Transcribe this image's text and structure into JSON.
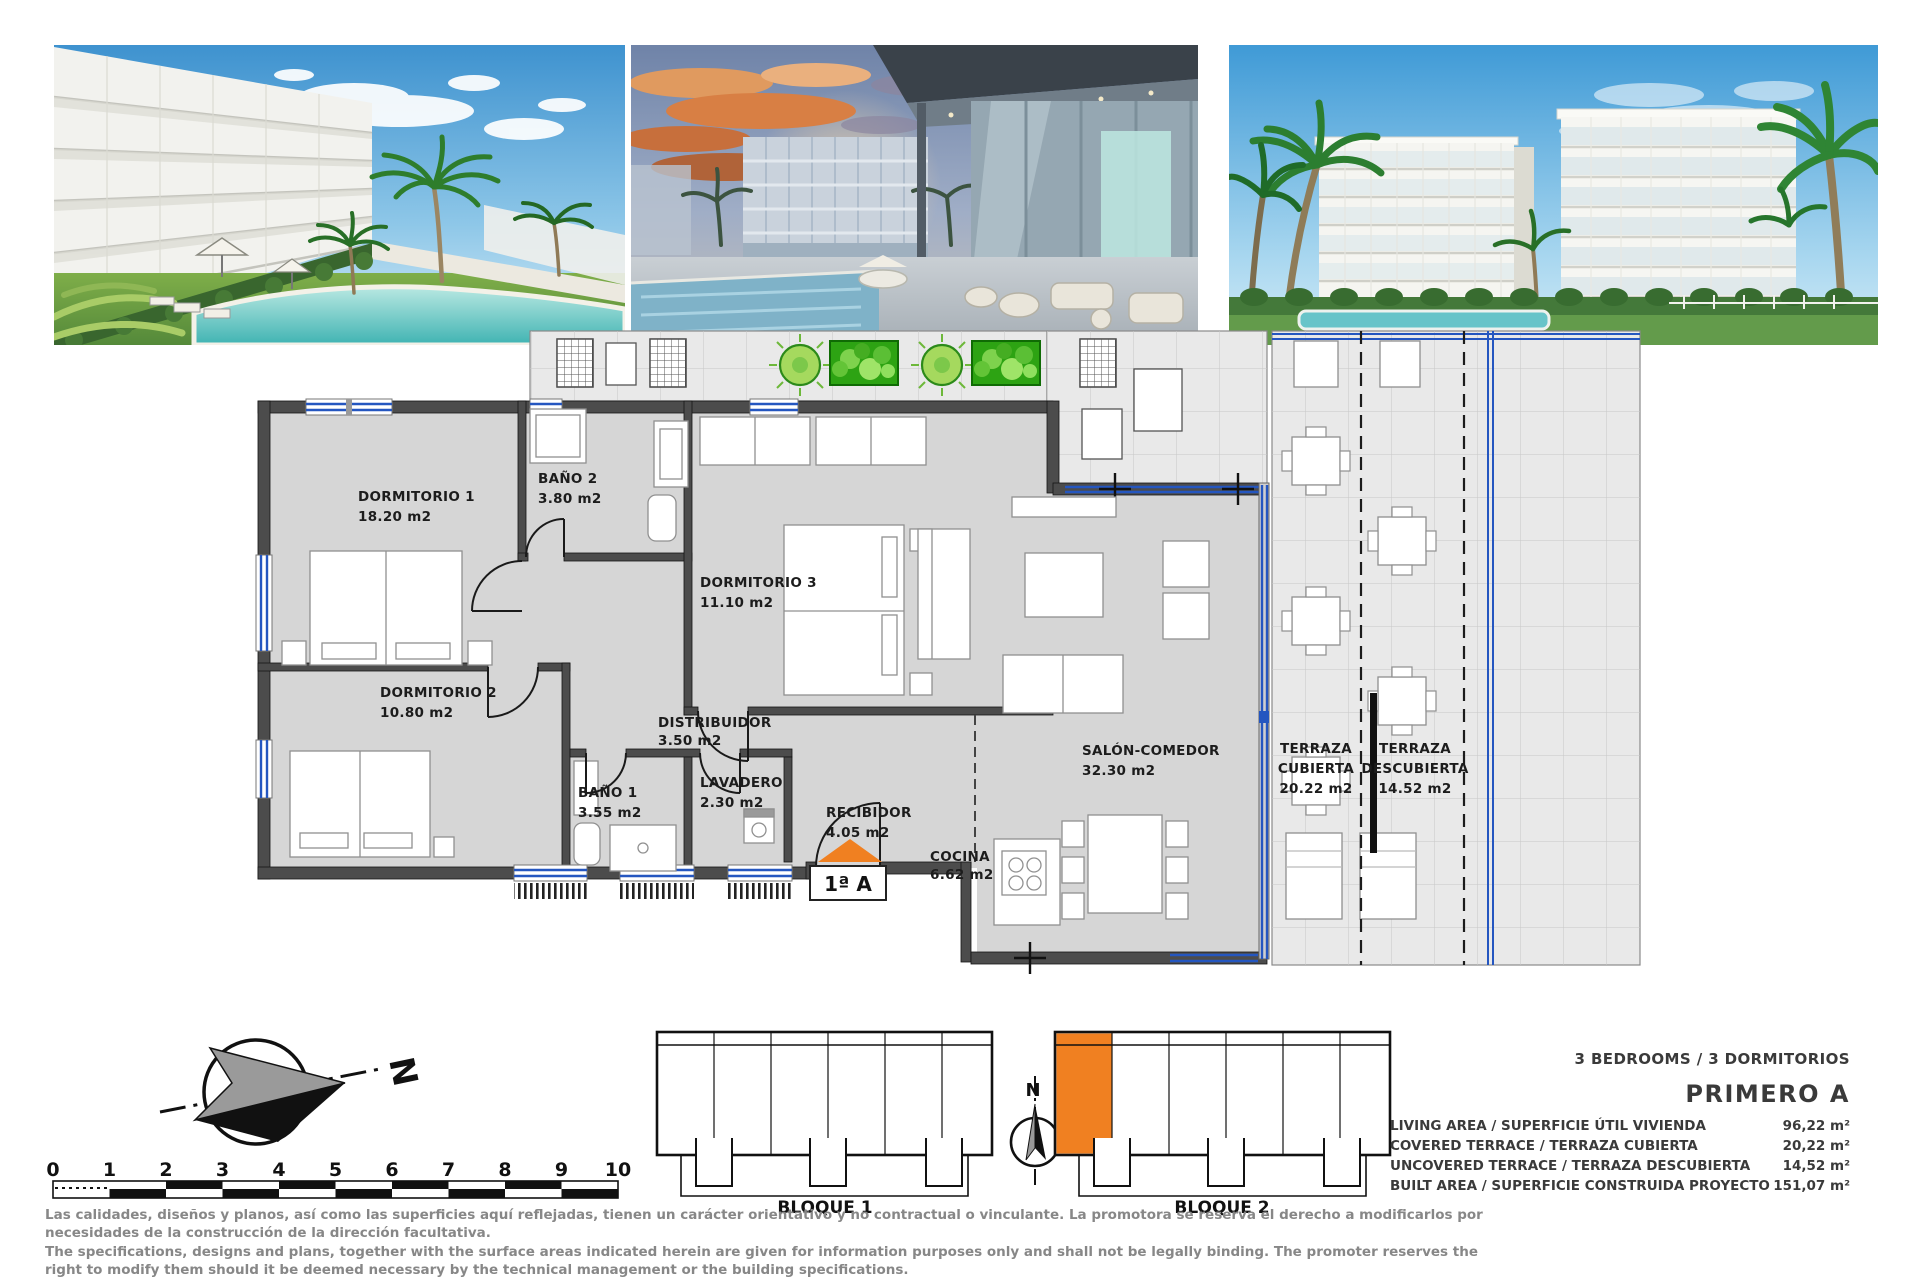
{
  "colors": {
    "accent_orange": "#f08021",
    "window_blue": "#2456c0",
    "plan_wall": "#4c4c4c",
    "plan_floor": "#d6d6d6",
    "terrace_floor": "#e9e9e9",
    "plant_green": "#45b31e",
    "disclaimer_gray": "#878787"
  },
  "floor_plan": {
    "unit_badge": "1ª A",
    "rooms": [
      {
        "id": "dormitorio-1",
        "line1": "DORMITORIO 1",
        "line2": "18.20 m2"
      },
      {
        "id": "bano-2",
        "line1": "BAÑO 2",
        "line2": "3.80 m2"
      },
      {
        "id": "dormitorio-3",
        "line1": "DORMITORIO 3",
        "line2": "11.10 m2"
      },
      {
        "id": "dormitorio-2",
        "line1": "DORMITORIO 2",
        "line2": "10.80 m2"
      },
      {
        "id": "distribuidor",
        "line1": "DISTRIBUIDOR",
        "line2": "3.50 m2"
      },
      {
        "id": "bano-1",
        "line1": "BAÑO 1",
        "line2": "3.55 m2"
      },
      {
        "id": "lavadero",
        "line1": "LAVADERO",
        "line2": "2.30 m2"
      },
      {
        "id": "recibidor",
        "line1": "RECIBIDOR",
        "line2": "4.05 m2"
      },
      {
        "id": "cocina",
        "line1": "COCINA",
        "line2": "6.62 m2"
      },
      {
        "id": "salon-comedor",
        "line1": "SALÓN-COMEDOR",
        "line2": "32.30 m2"
      },
      {
        "id": "terraza-cubierta",
        "line1": "TERRAZA",
        "line2": "CUBIERTA",
        "line3": "20.22 m2"
      },
      {
        "id": "terraza-descubierta",
        "line1": "TERRAZA",
        "line2": "DESCUBIERTA",
        "line3": "14.52 m2"
      }
    ]
  },
  "bottom": {
    "compass_label": "N",
    "compass_small_label": "N",
    "scale_ticks": [
      "0",
      "1",
      "2",
      "3",
      "4",
      "5",
      "6",
      "7",
      "8",
      "9",
      "10"
    ],
    "blocks": [
      {
        "label": "BLOQUE 1"
      },
      {
        "label": "BLOQUE 2"
      }
    ]
  },
  "details": {
    "header": "3 BEDROOMS / 3 DORMITORIOS",
    "unit_name": "PRIMERO A",
    "rows": [
      {
        "label": "LIVING AREA / SUPERFICIE ÚTIL VIVIENDA",
        "value": "96,22 m²"
      },
      {
        "label": "COVERED TERRACE / TERRAZA CUBIERTA",
        "value": "20,22 m²"
      },
      {
        "label": "UNCOVERED TERRACE / TERRAZA DESCUBIERTA",
        "value": "14,52 m²"
      },
      {
        "label": "BUILT AREA / SUPERFICIE CONSTRUIDA PROYECTO",
        "value": "151,07 m²"
      }
    ]
  },
  "disclaimer": {
    "lines": [
      "Las calidades, diseños y planos, así como las superficies aquí reflejadas, tienen un carácter orientativo y no contractual o vinculante. La promotora se reserva el derecho a modificarlos por",
      "necesidades de la construcción de la dirección facultativa.",
      "The specifications, designs and plans, together with the surface areas indicated herein are given for information purposes only and shall not be legally binding. The promoter reserves the",
      "right to modify them should it be deemed necessary by the technical management or the building specifications."
    ]
  }
}
